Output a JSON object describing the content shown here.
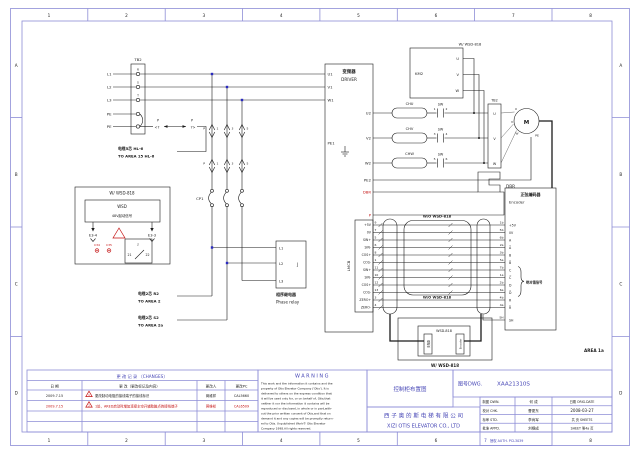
{
  "colors": {
    "frame": "#8d8dd6",
    "blue_text": "#4646b6",
    "red": "#c41212",
    "line": "#1b1b1b",
    "junction": "#2a2ac0"
  },
  "frame": {
    "numbers": [
      "1",
      "2",
      "3",
      "4",
      "5",
      "6",
      "7",
      "8"
    ],
    "letters": [
      "A",
      "B",
      "C",
      "D"
    ],
    "area": "AREA 1a",
    "auth": "授权 AUTH. PCL3039"
  },
  "tb2_left": {
    "title": "TB2",
    "lines": [
      "L1",
      "L2",
      "L3",
      "PE",
      "PE"
    ],
    "pins": [
      "R",
      "S",
      "T"
    ]
  },
  "plug": {
    "p1": "P",
    "p2": "P",
    "n1": "<7",
    "n2": "7>"
  },
  "note_hl6": {
    "l1": "电缆5芯 HL-6",
    "l2": "TO AREA 15 HL-6"
  },
  "breaker": {
    "cp1": "CP1",
    "p_top": "P",
    "p_bot": "P",
    "top": [
      "1",
      "3",
      "5"
    ],
    "bot": [
      "1",
      "3",
      "5"
    ]
  },
  "wsd_opt": {
    "title": "W/ WSD-818",
    "wsd": "WSD",
    "sig": "48V起动信号",
    "e34": "E3-4",
    "e33": "E3-3",
    "j": "J",
    "n21": "21",
    "n22": "22",
    "c34": "C34",
    "c35": "C35"
  },
  "relay": {
    "l1": "L1",
    "l2": "L2",
    "l3": "L3",
    "j": "J",
    "cn": "相序继电器",
    "en": "Phase relay"
  },
  "note_r2": {
    "l1": "电缆2芯 R2",
    "l2": "TO AREA 2"
  },
  "note_s2": {
    "l1": "电缆2芯 S2",
    "l2": "TO AREA 2a"
  },
  "driver": {
    "cn": "变频器",
    "en": "DRIVER",
    "u1": "U1",
    "v1": "V1",
    "w1": "W1",
    "pe1": "PE1",
    "u2": "U2",
    "v2": "V2",
    "w2": "W2",
    "pe2": "PE2",
    "dbr": "DBR",
    "p": "P"
  },
  "lmcb": {
    "label": "LMCB",
    "names": [
      "+5V",
      "0V",
      "SIN+",
      "SIN-",
      "COS+",
      "COS-",
      "SIN+",
      "SIN-",
      "COS+",
      "COS-",
      "ZERO+",
      "ZERO-"
    ],
    "nums": [
      "9",
      "7",
      "5",
      "6",
      "8",
      "1",
      "11",
      "10",
      "12",
      "13",
      "3",
      "4"
    ]
  },
  "chokes": [
    "CHU",
    "CHV",
    "CHW"
  ],
  "sw": {
    "label": "SW",
    "nums": [
      [
        "1",
        "2"
      ],
      [
        "3",
        "4"
      ],
      [
        "5",
        "6"
      ]
    ]
  },
  "km2": {
    "label": "KM2",
    "u": "U",
    "v": "V",
    "w": "W",
    "note": "W/ WSD-818"
  },
  "tb2_right": {
    "title": "TB2",
    "u": "U",
    "v": "V",
    "w": "W"
  },
  "motor": {
    "m": "M",
    "u": "U",
    "v": "V",
    "w": "W",
    "pe": "PE"
  },
  "dbr": {
    "label": "DBR"
  },
  "bundle": {
    "top": "W/O WSD-818",
    "bottom": "W/O WSD-818"
  },
  "wsd818": {
    "module": "WSD-818",
    "caption": "W/ WSD-818",
    "left": "变频器",
    "right": "Encoder"
  },
  "encoder": {
    "cn": "正弦编码器",
    "en": "Encoder",
    "brace": "绝对值信号",
    "wires": [
      "1b",
      "5b",
      "6b",
      "2a",
      "3b",
      "5a",
      "7b",
      "1a",
      "2b",
      "6a",
      "4b",
      "4a"
    ],
    "names": [
      "+5V",
      "0V",
      "A",
      "A̅",
      "B",
      "B̅",
      "C",
      "C̅",
      "D",
      "D̅",
      "R",
      "R̅"
    ],
    "sh_wire": "SH",
    "sh": "SH"
  },
  "changes": {
    "title": "更 改 记 录 （CHANGES）",
    "h_date": "日 期",
    "h_change": "更 改（更改标记及内容）",
    "h_person": "更改人",
    "h_pc": "更改PC",
    "rows": [
      {
        "date": "2009.7.15",
        "mark": "1",
        "text": "更改制动电阻的接线端子的接线标识",
        "person": "蒋维祥",
        "pc": "CAL5660"
      },
      {
        "date": "2009.7.15",
        "mark": "2",
        "text": "1处，ARED启动时增加连接主空开辅助触点的接线端子",
        "person": "蒋维祥",
        "pc": "CAL6509"
      }
    ]
  },
  "warning": {
    "title": "WARNING",
    "lines": [
      "This work and the information it contains and the",
      "property of Otis Elevator Company ('Otis'). It is",
      "delivered to others on the express condition that",
      "it will be used only for, or on behalf of, Otis;that",
      "neither it nor the information it contains will be",
      "reproduced or disclosed, in whole or in part,with-",
      "out the prior written consent of Otis,and that on",
      "demand it and any copies will be promptly return-",
      "ed to Otis.  Unpublished Work© Otis Elevator",
      "Company 1998.All rights reserved."
    ]
  },
  "tb": {
    "title": "控制柜布置图",
    "dwg_label": "图号DWG.",
    "dwg_no": "XAA21310S",
    "co_cn": "西 子 奥 的 斯 电 梯 有 限 公 司",
    "co_en": "XIZI OTIS ELEVATOR CO., LTD",
    "dwn_l": "制图 DWN.",
    "dwn": "何 成",
    "chk_l": "校对 CHK.",
    "chk": "曹更东",
    "std_l": "标审 STD.",
    "std": "李尚军",
    "appd_l": "批准 APPD.",
    "appd": "刘根成",
    "date_l": "日期 ORIG.DATE",
    "date": "2008-03-27",
    "sheets_l": "共 页 SHEETS",
    "sheet": "SHEET 第4a 页"
  }
}
